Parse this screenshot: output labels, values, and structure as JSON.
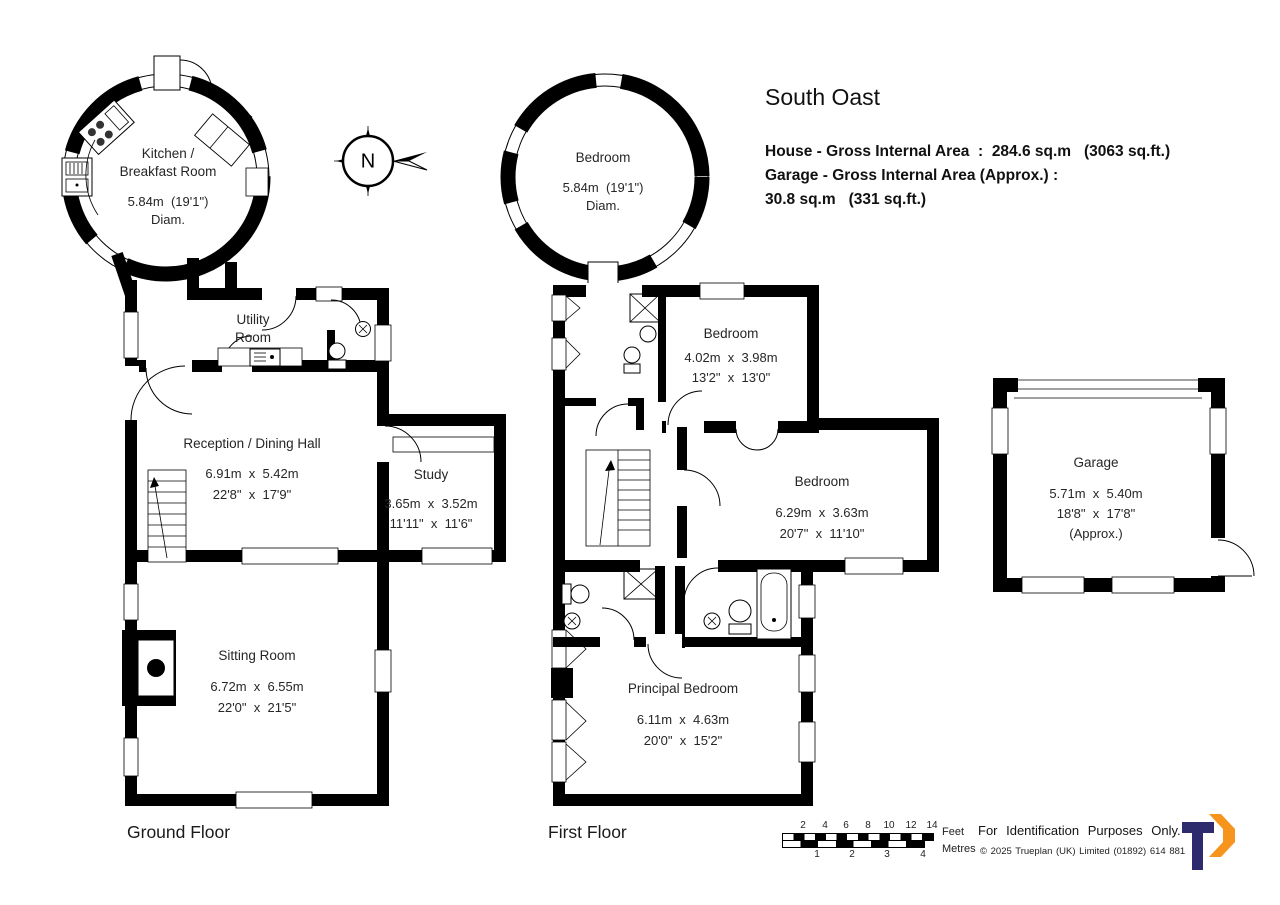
{
  "header": {
    "title": "South Oast",
    "area_line1": "House - Gross Internal Area  :  284.6 sq.m   (3063 sq.ft.)",
    "area_line2": "Garage - Gross Internal Area (Approx.) :",
    "area_line3": "30.8 sq.m   (331 sq.ft.)"
  },
  "compass": {
    "north_label": "N"
  },
  "ground_floor": {
    "label": "Ground Floor",
    "kitchen": {
      "name1": "Kitchen /",
      "name2": "Breakfast Room",
      "dim": "5.84m  (19'1\")",
      "diam": "Diam."
    },
    "utility": {
      "name1": "Utility",
      "name2": "Room"
    },
    "reception": {
      "name": "Reception / Dining Hall",
      "dim_m": "6.91m  x  5.42m",
      "dim_ft": "22'8\"  x  17'9\""
    },
    "study": {
      "name": "Study",
      "dim_m": "3.65m  x  3.52m",
      "dim_ft": "11'11\"  x  11'6\""
    },
    "sitting": {
      "name": "Sitting Room",
      "dim_m": "6.72m  x  6.55m",
      "dim_ft": "22'0\"  x  21'5\""
    }
  },
  "first_floor": {
    "label": "First Floor",
    "bedroom_round": {
      "name": "Bedroom",
      "dim": "5.84m  (19'1\")",
      "diam": "Diam."
    },
    "bedroom_front": {
      "name": "Bedroom",
      "dim_m": "4.02m  x  3.98m",
      "dim_ft": "13'2\"  x  13'0\""
    },
    "bedroom_rear": {
      "name": "Bedroom",
      "dim_m": "6.29m  x  3.63m",
      "dim_ft": "20'7\"  x  11'10\""
    },
    "principal": {
      "name": "Principal Bedroom",
      "dim_m": "6.11m  x  4.63m",
      "dim_ft": "20'0\"  x  15'2\""
    }
  },
  "garage": {
    "name": "Garage",
    "dim_m": "5.71m  x  5.40m",
    "dim_ft": "18'8\"  x  17'8\"",
    "approx": "(Approx.)"
  },
  "scale": {
    "feet_numbers": [
      "2",
      "4",
      "6",
      "8",
      "10",
      "12",
      "14"
    ],
    "metre_numbers": [
      "1",
      "2",
      "3",
      "4"
    ],
    "feet_label": "Feet",
    "metres_label": "Metres"
  },
  "footer": {
    "identification": "For Identification Purposes Only.",
    "copyright": "©  2025 Trueplan (UK) Limited  (01892) 614 881"
  },
  "colors": {
    "wall": "#000000",
    "logo_navy": "#2e2a6e",
    "logo_orange": "#f7941e"
  }
}
